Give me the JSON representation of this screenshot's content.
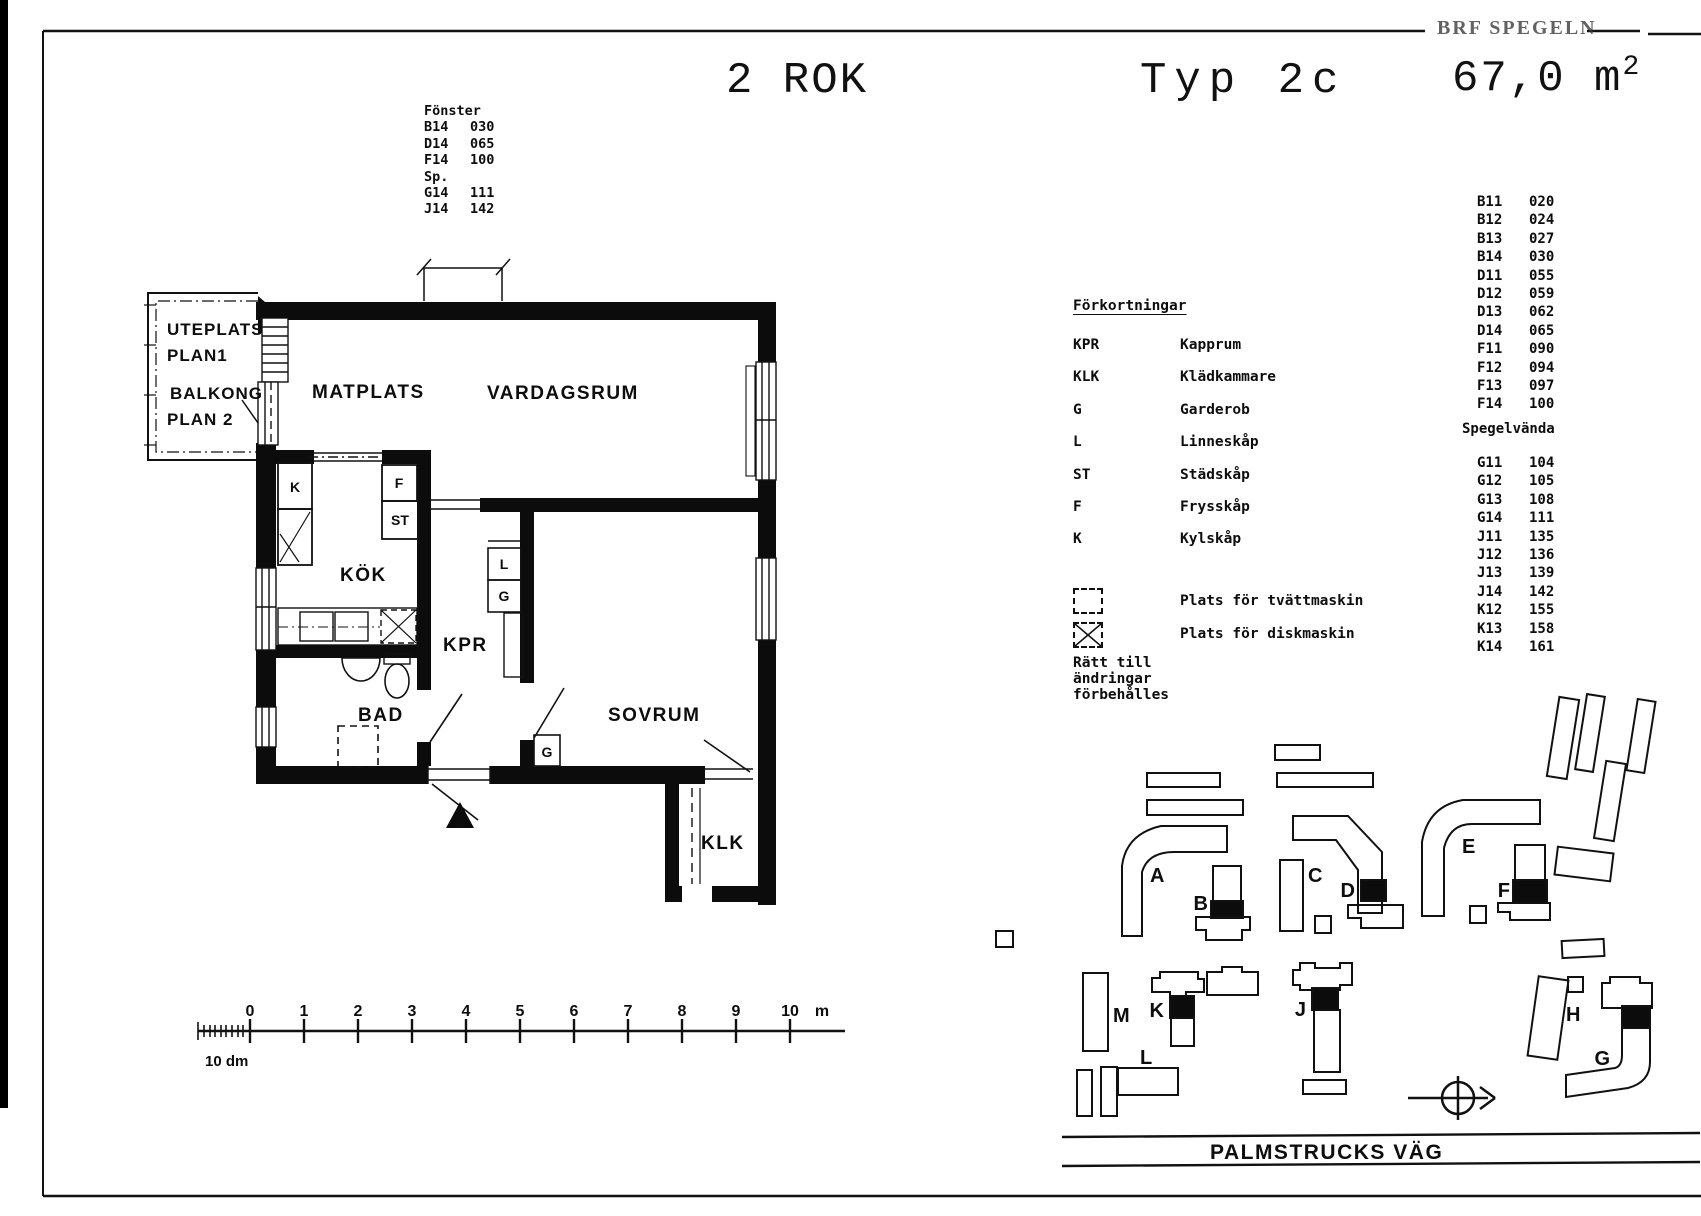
{
  "page": {
    "brand": "BRF SPEGELN",
    "title": {
      "rooms": "2 ROK",
      "type": "Typ 2c",
      "area": "67,0 m",
      "area_sup": "2"
    }
  },
  "fonster": {
    "heading": "Fönster",
    "items": [
      {
        "code": "B14",
        "num": "030"
      },
      {
        "code": "D14",
        "num": "065"
      },
      {
        "code": "F14",
        "num": "100"
      },
      {
        "code": "Sp.",
        "num": ""
      },
      {
        "code": "G14",
        "num": "111"
      },
      {
        "code": "J14",
        "num": "142"
      }
    ]
  },
  "units": {
    "items": [
      {
        "code": "B11",
        "num": "020"
      },
      {
        "code": "B12",
        "num": "024"
      },
      {
        "code": "B13",
        "num": "027"
      },
      {
        "code": "B14",
        "num": "030"
      },
      {
        "code": "D11",
        "num": "055"
      },
      {
        "code": "D12",
        "num": "059"
      },
      {
        "code": "D13",
        "num": "062"
      },
      {
        "code": "D14",
        "num": "065"
      },
      {
        "code": "F11",
        "num": "090"
      },
      {
        "code": "F12",
        "num": "094"
      },
      {
        "code": "F13",
        "num": "097"
      },
      {
        "code": "F14",
        "num": "100"
      }
    ],
    "mirror_heading": "Spegelvända",
    "mirror_items": [
      {
        "code": "G11",
        "num": "104"
      },
      {
        "code": "G12",
        "num": "105"
      },
      {
        "code": "G13",
        "num": "108"
      },
      {
        "code": "G14",
        "num": "111"
      },
      {
        "code": "J11",
        "num": "135"
      },
      {
        "code": "J12",
        "num": "136"
      },
      {
        "code": "J13",
        "num": "139"
      },
      {
        "code": "J14",
        "num": "142"
      },
      {
        "code": "K12",
        "num": "155"
      },
      {
        "code": "K13",
        "num": "158"
      },
      {
        "code": "K14",
        "num": "161"
      }
    ]
  },
  "legend": {
    "heading": "Förkortningar",
    "items": [
      {
        "abbr": "KPR",
        "label": "Kapprum"
      },
      {
        "abbr": "KLK",
        "label": "Klädkammare"
      },
      {
        "abbr": "G",
        "label": "Garderob"
      },
      {
        "abbr": "L",
        "label": "Linneskåp"
      },
      {
        "abbr": "ST",
        "label": "Städskåp"
      },
      {
        "abbr": "F",
        "label": "Frysskåp"
      },
      {
        "abbr": "K",
        "label": "Kylskåp"
      }
    ],
    "washer": "Plats för tvättmaskin",
    "dishwasher": "Plats för diskmaskin",
    "note": "Rätt till ändringar förbehålles"
  },
  "plan": {
    "rooms": {
      "matplats": "MATPLATS",
      "vardagsrum": "VARDAGSRUM",
      "kok": "KÖK",
      "kpr": "KPR",
      "bad": "BAD",
      "sovrum": "SOVRUM",
      "klk": "KLK"
    },
    "outdoor": {
      "uteplats": "UTEPLATS",
      "plan1": "PLAN1",
      "balkong": "BALKONG",
      "plan2": "PLAN 2"
    },
    "cabinets": {
      "k": "K",
      "f": "F",
      "st": "ST",
      "l": "L",
      "g_upper": "G",
      "g_sovrum": "G"
    }
  },
  "scalebar": {
    "ticks": [
      "0",
      "1",
      "2",
      "3",
      "4",
      "5",
      "6",
      "7",
      "8",
      "9",
      "10"
    ],
    "unit": "m",
    "sub": "10 dm"
  },
  "site": {
    "street": "PALMSTRUCKS VÄG",
    "labels": {
      "a": "A",
      "b": "B",
      "c": "C",
      "d": "D",
      "e": "E",
      "f": "F",
      "g": "G",
      "h": "H",
      "j": "J",
      "k": "K",
      "l": "L",
      "m": "M"
    }
  }
}
